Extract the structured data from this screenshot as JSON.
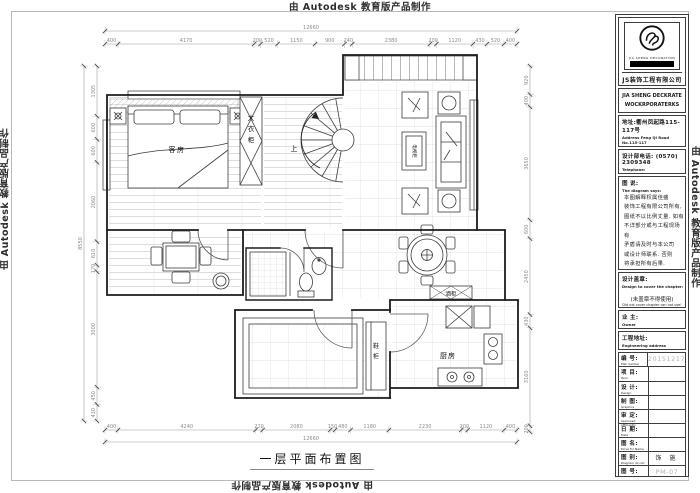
{
  "watermark": {
    "text": "由 Autodesk 教育版产品制作"
  },
  "sheet": {
    "title": "一层平面布置图"
  },
  "plan": {
    "labels": {
      "guest_room": "客房",
      "wardrobe": "大衣柜",
      "stair_up": "上",
      "tv_cabinet": "电视柜",
      "wine_cabinet": "酒柜",
      "shoe_cabinet": "鞋柜",
      "kitchen": "厨房"
    },
    "dimensions": {
      "top_total": "12660",
      "top_segments": [
        "400",
        "4170",
        "200",
        "520",
        "1150",
        "900",
        "240",
        "2380",
        "200",
        "1120",
        "430",
        "520",
        "400"
      ],
      "bottom_total": "12660",
      "bottom_segments": [
        "400",
        "4240",
        "220",
        "2080",
        "150",
        "480",
        "1180",
        "2230",
        "200",
        "1120",
        "400"
      ],
      "left_total": "8550",
      "left_segments": [
        "1305",
        "600",
        "600",
        "2060",
        "610",
        "170",
        "3000",
        "450",
        "430"
      ],
      "right_segments": [
        "920",
        "400",
        "3650",
        "600",
        "2450",
        "430",
        "3160",
        "200"
      ]
    }
  },
  "titleblock": {
    "logo_caption": "JIA SHENG DECORATION",
    "company_cn": "JS装饰工程有限公司",
    "company_en_line1": "JIA SHENG DECKRATE",
    "company_en_line2": "WOCKRPORATERKS",
    "address_cn": "地址:衢州凤起路115-117号",
    "address_en": "Address Feng Qi Road No.115-117",
    "phone_cn": "设计部电话:",
    "phone_value": "(0570) 2309348",
    "phone_en": "Telephone:",
    "notes_title_cn": "图 说:",
    "notes_title_en": "The diagram says:",
    "notes": [
      "本图解释权属佳盛",
      "装饰工程有限公司所有,",
      "图纸不以比例丈量. 如有",
      "不详部分或与工程现场有",
      "矛盾请及时与本公司",
      "或设计师联系. 否则",
      "将承担所有后果."
    ],
    "seal_cn": "设计盖章:",
    "seal_en": "Design to cover the chapter:",
    "seal_warning_cn": "(未盖章不得使用)",
    "seal_warning_en": "Did not cover chapter can not use!",
    "owner_cn": "业 主:",
    "owner_en": "Owner",
    "site_cn": "工程地址:",
    "site_en": "Engineering address",
    "rows": [
      {
        "cn": "编 号:",
        "en": "Plat number",
        "value": "20151217"
      },
      {
        "cn": "项 目:",
        "en": "Item",
        "value": ""
      },
      {
        "cn": "设 计:",
        "en": "Design",
        "value": ""
      },
      {
        "cn": "制 图:",
        "en": "Graphics",
        "value": ""
      },
      {
        "cn": "审 定:",
        "en": "Approved efficiently",
        "value": ""
      },
      {
        "cn": "日 期:",
        "en": "Date",
        "value": ""
      },
      {
        "cn": "图 名:",
        "en": "Drive for Name",
        "value": ""
      },
      {
        "cn": "图 别:",
        "en": "Diagram do not",
        "value": "饰 施"
      },
      {
        "cn": "图 号:",
        "en": "Diagram number",
        "value": "PM-07"
      }
    ],
    "muted_value_color": "#b3b3b3"
  }
}
